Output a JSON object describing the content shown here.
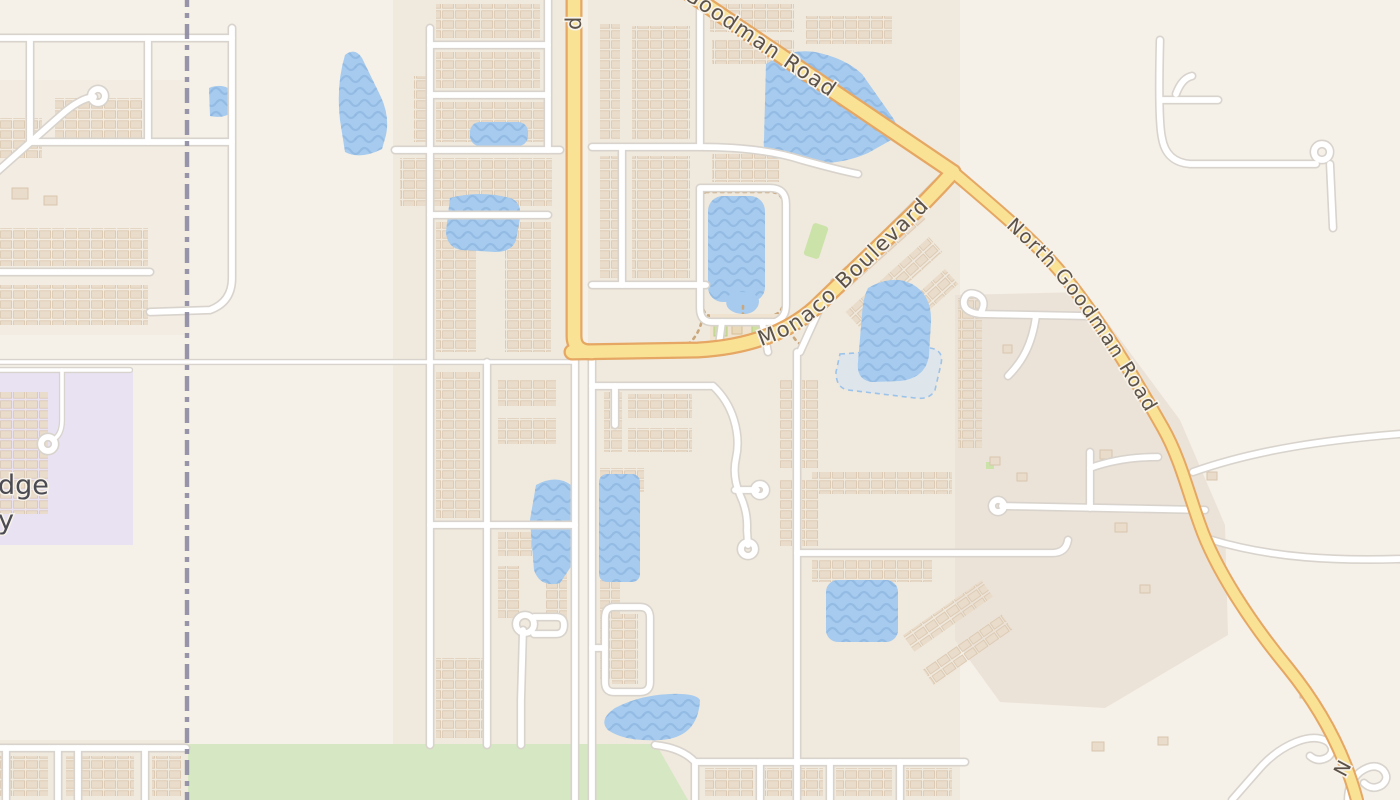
{
  "map": {
    "labels": {
      "goodman_road": "Goodman Road",
      "north_goodman_road": "North Goodman Road",
      "monaco_boulevard": "Monaco Boulevard",
      "top_road_fragment": "d",
      "bottom_road_fragment": "N",
      "place_fragment_line1": "dge",
      "place_fragment_line2": "y"
    },
    "colors": {
      "bg": "#f5f0e8",
      "residential": "#f0e9dd",
      "commercial": "#ece3d8",
      "institution": "#e9e2f2",
      "park": "#d6e7c3",
      "grass": "#cbe2a9",
      "water": "#a6cbee",
      "wave": "#8fb6e0",
      "water_intermittent": "#cfe2f6",
      "road_fill": "#ffffff",
      "road_casing": "#d8d3cc",
      "major_fill": "#f9e294",
      "major_casing": "#e5a763",
      "building": "#e9dcca",
      "building_stroke": "#d9c6ae",
      "boundary": "#8d89a2",
      "trail": "#c9a87d",
      "road_label": "#5c5247",
      "place_label": "#4b4b53",
      "halo": "#f7f2ea"
    }
  }
}
